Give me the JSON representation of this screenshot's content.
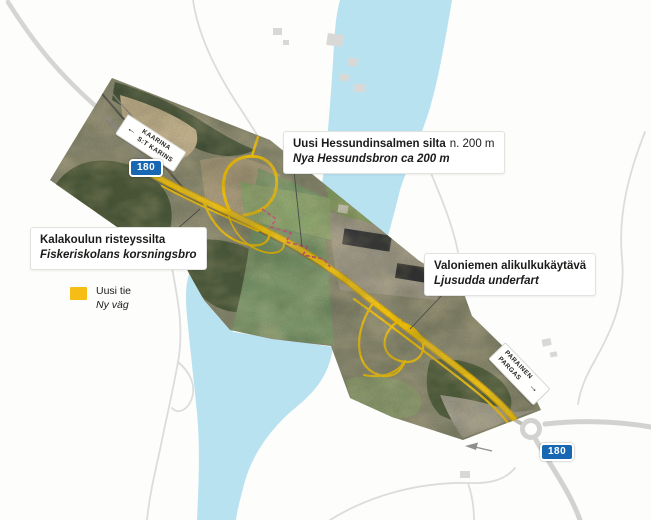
{
  "map": {
    "labels": {
      "bridge": {
        "fi_bold": "Uusi Hessundinsalmen silta",
        "fi_detail": "n. 200 m",
        "sv_italic": "Nya Hessundsbron ca 200 m"
      },
      "crossing": {
        "fi": "Kalakoulun risteyssilta",
        "sv": "Fiskeriskolans korsningsbro"
      },
      "underpass": {
        "fi": "Valoniemen alikulkukäytävä",
        "sv": "Ljusudda underfart"
      }
    },
    "legend": {
      "new_road_fi": "Uusi tie",
      "new_road_sv": "Ny väg",
      "swatch_color": "#F6BD16"
    },
    "direction_signs": {
      "kaarina": {
        "line1": "KAARINA",
        "line2": "S:T KARINS",
        "arrow": "←"
      },
      "parainen": {
        "line1": "PARAINEN",
        "line2": "PARGAS",
        "arrow": "→"
      }
    },
    "route_badge": "180",
    "colors": {
      "new_road_yellow": "#F5C206",
      "map_water_blue": "#B9E2F1",
      "badge_blue": "#1767B3",
      "bridge_alignment_pink": "#D6477D",
      "map_road_gray": "#DCDCDC"
    }
  }
}
